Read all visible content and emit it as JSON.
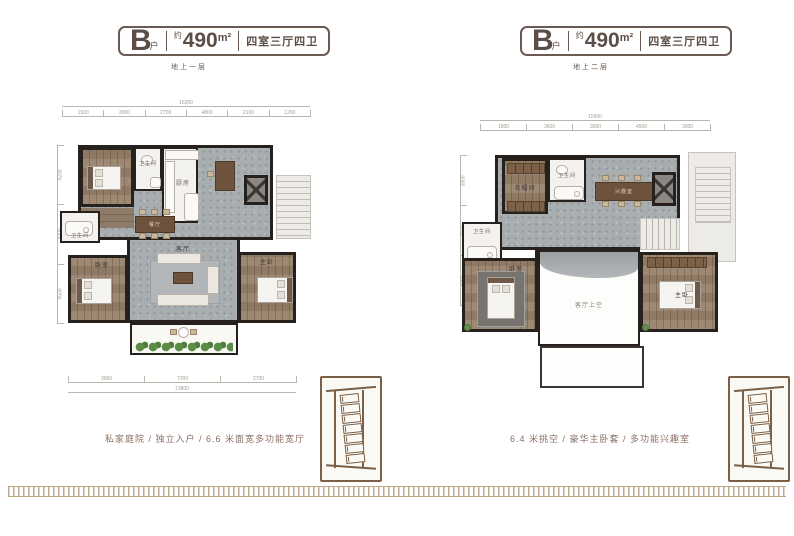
{
  "plans": [
    {
      "badge": {
        "letter": "B",
        "letter_sub": "户",
        "approx": "约",
        "area_value": "490",
        "area_unit": "m²",
        "layout": "四室三厅四卫"
      },
      "floor_label": "地上一层",
      "caption": "私家庭院 / 独立入户 / 6.6 米面宽多功能宽厅",
      "rooms": {
        "bedroom_top": "老人房",
        "bath_top": "卫生间",
        "kitchen": "厨房",
        "bath_mid": "卫生间",
        "dining": "餐厅",
        "living": "客厅",
        "bedroom_left": "卧室",
        "bedroom_right": "主卧"
      },
      "dims": {
        "total_top": "16200",
        "top": [
          "1500",
          "3900",
          "2700",
          "4800",
          "2100",
          "1200"
        ],
        "bottom": [
          "3900",
          "7200",
          "2700"
        ],
        "total_bottom": "13800",
        "left": [
          "4200",
          "3300",
          "4500"
        ]
      }
    },
    {
      "badge": {
        "letter": "B",
        "letter_sub": "户",
        "approx": "约",
        "area_value": "490",
        "area_unit": "m²",
        "layout": "四室三厅四卫"
      },
      "floor_label": "地上二层",
      "caption": "6.4 米挑空 / 豪华主卧套 / 多功能兴趣室",
      "rooms": {
        "closet": "衣帽间",
        "bath_top": "卫生间",
        "hobby": "兴趣室",
        "bath_mid": "卫生间",
        "bedroom_left": "卧室",
        "void": "客厅上空",
        "bedroom_right": "主卧"
      },
      "dims": {
        "total_top": "15900",
        "top": [
          "1800",
          "3600",
          "3000",
          "4500",
          "3000"
        ],
        "left": [
          "3900",
          "3600",
          "4800"
        ]
      }
    }
  ],
  "colors": {
    "accent_brown": "#6e5a4e",
    "wall": "#26211d",
    "floor_gray": "#a8adb0",
    "wood": "#97816b",
    "courtyard_green": "#5c8d48"
  }
}
